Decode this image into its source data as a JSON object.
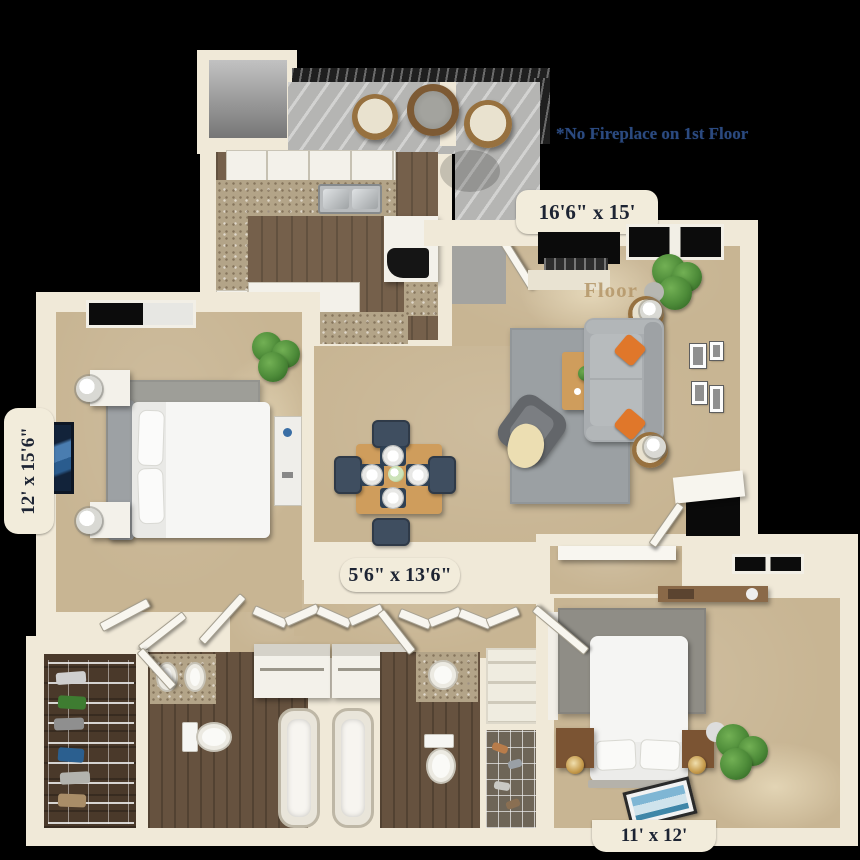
{
  "annotations": {
    "note": {
      "text": "*No Fireplace on 1st Floor"
    },
    "watermark": {
      "text": "Floor"
    }
  },
  "dimension_labels": {
    "living_room": "16'6\" x 15'",
    "master_bedroom": "12' x 15'6\"",
    "hallway": "5'6\" x 13'6\"",
    "bedroom_two": "11' x 12'"
  },
  "palette": {
    "background": "#000000",
    "wall": "#f0e9d8",
    "wall_tab": "#f2ecdb",
    "carpet": "#c8b593",
    "wood_floor": "#75604b",
    "bath_wood_floor": "#66523f",
    "closet_wood_floor": "#4a392a",
    "balcony_concrete": "#b5b5b3",
    "railing": "#1f1f1f",
    "granite_counter": "#b3a488",
    "area_rug": "#9ba0a3",
    "sofa": "#a9adb0",
    "accent_pillow": "#e0772a",
    "dining_chair": "#3f4e60",
    "table_wood": "#cf9d5c",
    "plant_green": "#4c8a38",
    "label_text": "#1d2433",
    "note_text": "#2b4a80",
    "watermark_text": "#b49668"
  }
}
